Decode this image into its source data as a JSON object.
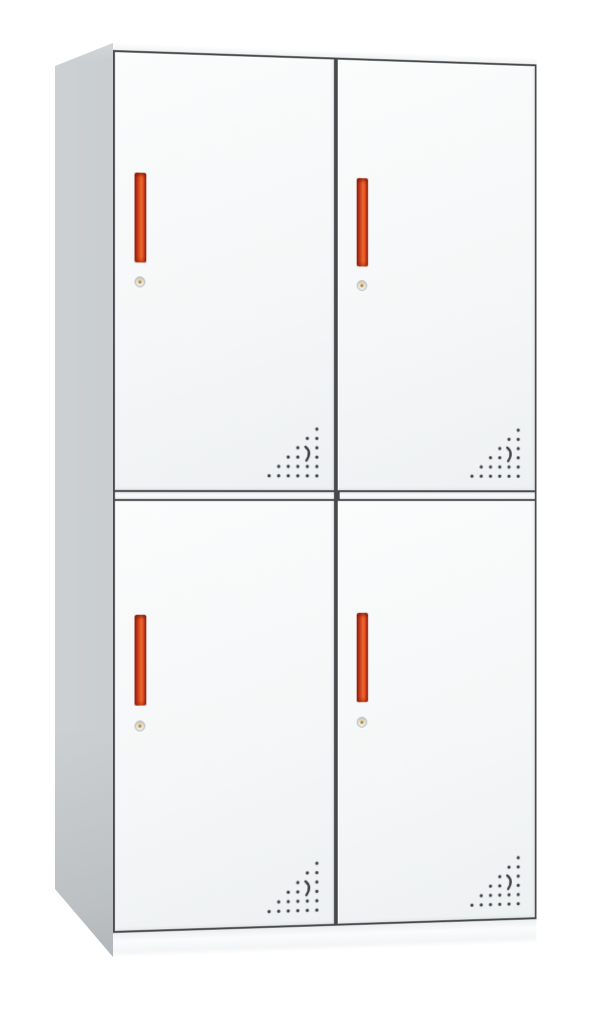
{
  "image": {
    "description": "White two-tier four-door steel locker cabinet with red vertical handles, round key locks and triangular perforated vents",
    "background": "#ffffff"
  },
  "cabinet": {
    "rows": 2,
    "columns": 2,
    "door_count": 4,
    "colors": {
      "door_face": "#f5f7f8",
      "side_panel": "#c2c7c9",
      "frame_line": "#46494c",
      "handle_red": "#d8431f",
      "handle_dark_red": "#8e2410",
      "vent_dot": "#3b3e42",
      "lock_ring": "#adb1b4",
      "lock_center": "#e5d1a1"
    },
    "doors": [
      {
        "position": "top-left",
        "handle": "vertical-red-bar",
        "lock": "round-cam-lock",
        "vent": "dot-triangle-with-crescent",
        "vent_location": "bottom-right"
      },
      {
        "position": "top-right",
        "handle": "vertical-red-bar",
        "lock": "round-cam-lock",
        "vent": "dot-triangle-with-crescent",
        "vent_location": "bottom-right"
      },
      {
        "position": "bottom-left",
        "handle": "vertical-red-bar",
        "lock": "round-cam-lock",
        "vent": "dot-triangle-with-crescent",
        "vent_location": "bottom-right"
      },
      {
        "position": "bottom-right",
        "handle": "vertical-red-bar",
        "lock": "round-cam-lock",
        "vent": "dot-triangle-with-crescent",
        "vent_location": "bottom-right"
      }
    ]
  }
}
